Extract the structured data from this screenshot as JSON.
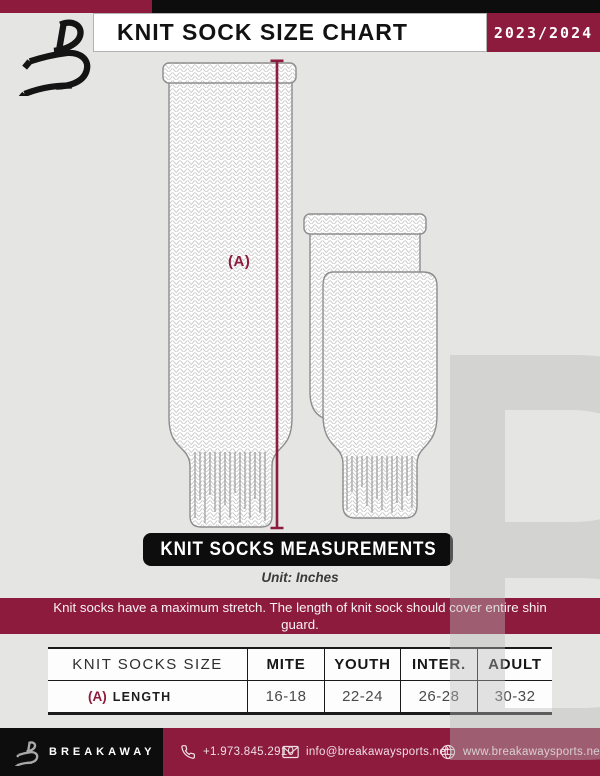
{
  "page": {
    "bg_color": "#E5E5E4",
    "accent_color": "#8C1B3E",
    "black_color": "#0D0D0D"
  },
  "header": {
    "title": "KNIT SOCK SIZE CHART",
    "season": "2023/2024"
  },
  "diagram": {
    "measurement_label": "(A)"
  },
  "measurements": {
    "banner": "KNIT SOCKS MEASUREMENTS",
    "unit": "Unit: Inches"
  },
  "notice": "Knit socks have a maximum stretch. The length of knit sock should cover entire shin guard.",
  "table": {
    "headers": [
      "KNIT SOCKS SIZE",
      "MITE",
      "YOUTH",
      "INTER.",
      "ADULT"
    ],
    "rows": [
      {
        "key": "(A)",
        "label": "LENGTH",
        "values": [
          "16-18",
          "22-24",
          "26-28",
          "30-32"
        ]
      }
    ]
  },
  "footer": {
    "brand": "BREAKAWAY",
    "phone": "+1.973.845.2910",
    "email": "info@breakawaysports.net",
    "website": "www.breakawaysports.net"
  }
}
